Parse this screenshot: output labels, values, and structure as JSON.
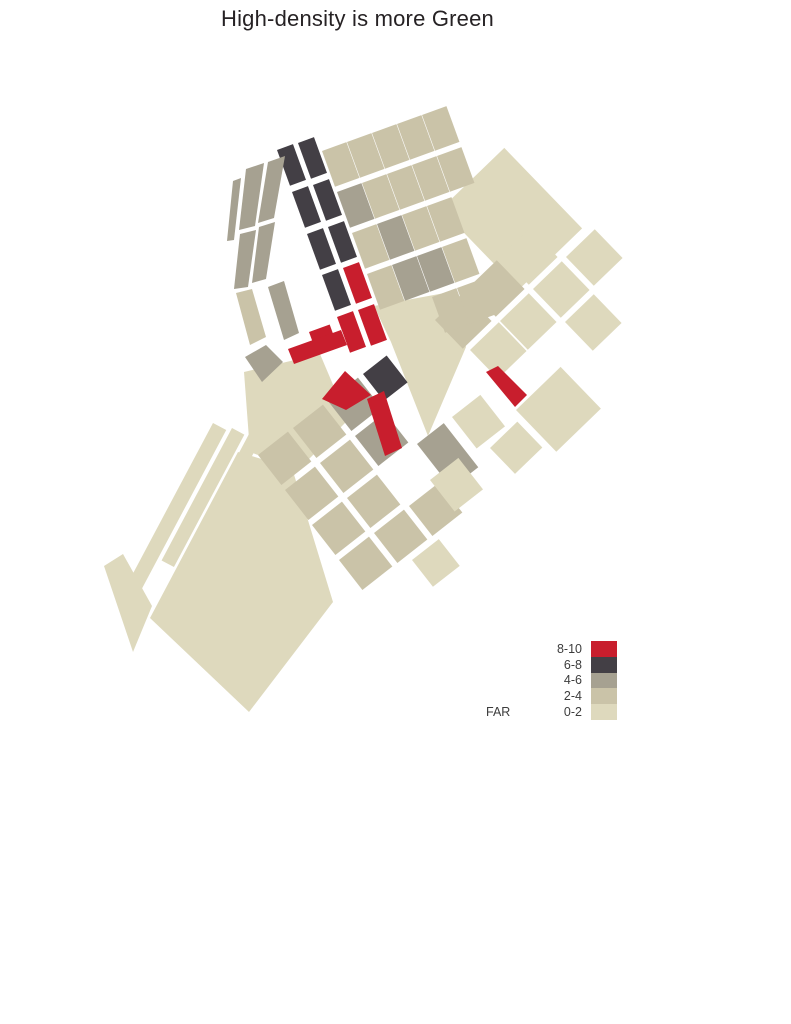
{
  "title": "High-density is more Green",
  "legend": {
    "label": "FAR",
    "entries": [
      {
        "range": "8-10",
        "color": "#c81e2d"
      },
      {
        "range": "6-8",
        "color": "#433f45"
      },
      {
        "range": "4-6",
        "color": "#a6a191"
      },
      {
        "range": "2-4",
        "color": "#cac3a8"
      },
      {
        "range": "0-2",
        "color": "#ded9bd"
      }
    ]
  },
  "map": {
    "blocks": [
      {
        "far": "0-2",
        "points": "374,306 450,292 466,347 428,436 391,342"
      },
      {
        "far": "0-2",
        "points": "244,372 320,354 348,420 298,470 250,452"
      },
      {
        "far": "0-2",
        "x": 213,
        "y": 423,
        "w": 15,
        "h": 195,
        "r": 28
      },
      {
        "far": "0-2",
        "x": 232,
        "y": 428,
        "w": 14,
        "h": 150,
        "r": 28
      },
      {
        "far": "0-2",
        "x": 249,
        "y": 434,
        "w": 13,
        "h": 115,
        "r": 28
      },
      {
        "far": "0-2",
        "points": "150,618 238,452 292,468 333,602 249,712"
      },
      {
        "far": "0-2",
        "points": "104,566 123,554 152,606 133,652"
      },
      {
        "far": "2-4",
        "x": 258,
        "y": 455,
        "w": 38,
        "h": 38,
        "r": -38
      },
      {
        "far": "2-4",
        "x": 293,
        "y": 428,
        "w": 38,
        "h": 38,
        "r": -38
      },
      {
        "far": "4-6",
        "x": 328,
        "y": 401,
        "w": 38,
        "h": 38,
        "r": -38
      },
      {
        "far": "6-8",
        "x": 363,
        "y": 374,
        "w": 30,
        "h": 34,
        "r": -38
      },
      {
        "far": "2-4",
        "x": 285,
        "y": 490,
        "w": 38,
        "h": 38,
        "r": -38
      },
      {
        "far": "2-4",
        "x": 320,
        "y": 463,
        "w": 38,
        "h": 38,
        "r": -38
      },
      {
        "far": "4-6",
        "x": 355,
        "y": 436,
        "w": 38,
        "h": 38,
        "r": -38
      },
      {
        "far": "2-4",
        "x": 312,
        "y": 525,
        "w": 38,
        "h": 38,
        "r": -38
      },
      {
        "far": "2-4",
        "x": 347,
        "y": 498,
        "w": 38,
        "h": 38,
        "r": -38
      },
      {
        "far": "4-6",
        "x": 417,
        "y": 444,
        "w": 34,
        "h": 56,
        "r": -38
      },
      {
        "far": "2-4",
        "x": 339,
        "y": 560,
        "w": 38,
        "h": 38,
        "r": -38
      },
      {
        "far": "2-4",
        "x": 374,
        "y": 533,
        "w": 38,
        "h": 38,
        "r": -38
      },
      {
        "far": "2-4",
        "x": 409,
        "y": 506,
        "w": 38,
        "h": 38,
        "r": -38
      },
      {
        "far": "0-2",
        "x": 452,
        "y": 417,
        "w": 36,
        "h": 40,
        "r": -38
      },
      {
        "far": "0-2",
        "x": 430,
        "y": 480,
        "w": 36,
        "h": 40,
        "r": -38
      },
      {
        "far": "0-2",
        "x": 412,
        "y": 560,
        "w": 34,
        "h": 34,
        "r": -38
      },
      {
        "far": "0-2",
        "x": 441,
        "y": 209,
        "w": 88,
        "h": 112,
        "r": -44
      },
      {
        "far": "2-4",
        "x": 435,
        "y": 320,
        "w": 40,
        "h": 40,
        "r": -44
      },
      {
        "far": "2-4",
        "x": 468,
        "y": 288,
        "w": 40,
        "h": 40,
        "r": -44
      },
      {
        "far": "0-2",
        "x": 501,
        "y": 256,
        "w": 40,
        "h": 40,
        "r": -44
      },
      {
        "far": "0-2",
        "x": 470,
        "y": 350,
        "w": 40,
        "h": 40,
        "r": -44
      },
      {
        "far": "0-2",
        "x": 500,
        "y": 321,
        "w": 40,
        "h": 40,
        "r": -44
      },
      {
        "far": "0-2",
        "x": 533,
        "y": 289,
        "w": 40,
        "h": 40,
        "r": -44
      },
      {
        "far": "0-2",
        "x": 566,
        "y": 257,
        "w": 40,
        "h": 40,
        "r": -44
      },
      {
        "far": "0-2",
        "x": 565,
        "y": 322,
        "w": 40,
        "h": 40,
        "r": -44
      },
      {
        "far": "0-2",
        "x": 516,
        "y": 410,
        "w": 62,
        "h": 58,
        "r": -44
      },
      {
        "far": "0-2",
        "x": 490,
        "y": 448,
        "w": 38,
        "h": 36,
        "r": -44
      },
      {
        "far": "2-4",
        "x": 322,
        "y": 151,
        "w": 26,
        "h": 38,
        "r": -20
      },
      {
        "far": "2-4",
        "x": 347,
        "y": 142,
        "w": 26,
        "h": 38,
        "r": -20
      },
      {
        "far": "2-4",
        "x": 372,
        "y": 133,
        "w": 26,
        "h": 38,
        "r": -20
      },
      {
        "far": "2-4",
        "x": 397,
        "y": 124,
        "w": 26,
        "h": 38,
        "r": -20
      },
      {
        "far": "2-4",
        "x": 422,
        "y": 115,
        "w": 26,
        "h": 38,
        "r": -20
      },
      {
        "far": "4-6",
        "x": 337,
        "y": 192,
        "w": 26,
        "h": 38,
        "r": -20
      },
      {
        "far": "2-4",
        "x": 362,
        "y": 183,
        "w": 26,
        "h": 38,
        "r": -20
      },
      {
        "far": "2-4",
        "x": 387,
        "y": 174,
        "w": 26,
        "h": 38,
        "r": -20
      },
      {
        "far": "2-4",
        "x": 412,
        "y": 165,
        "w": 26,
        "h": 38,
        "r": -20
      },
      {
        "far": "2-4",
        "x": 437,
        "y": 156,
        "w": 26,
        "h": 38,
        "r": -20
      },
      {
        "far": "2-4",
        "x": 352,
        "y": 233,
        "w": 26,
        "h": 38,
        "r": -20
      },
      {
        "far": "4-6",
        "x": 377,
        "y": 224,
        "w": 26,
        "h": 38,
        "r": -20
      },
      {
        "far": "2-4",
        "x": 402,
        "y": 215,
        "w": 26,
        "h": 38,
        "r": -20
      },
      {
        "far": "2-4",
        "x": 427,
        "y": 206,
        "w": 26,
        "h": 38,
        "r": -20
      },
      {
        "far": "2-4",
        "x": 367,
        "y": 274,
        "w": 26,
        "h": 38,
        "r": -20
      },
      {
        "far": "4-6",
        "x": 392,
        "y": 265,
        "w": 26,
        "h": 38,
        "r": -20
      },
      {
        "far": "4-6",
        "x": 417,
        "y": 256,
        "w": 26,
        "h": 38,
        "r": -20
      },
      {
        "far": "2-4",
        "x": 442,
        "y": 247,
        "w": 26,
        "h": 38,
        "r": -20
      },
      {
        "far": "2-4",
        "x": 432,
        "y": 297,
        "w": 26,
        "h": 38,
        "r": -20
      },
      {
        "far": "2-4",
        "x": 457,
        "y": 288,
        "w": 26,
        "h": 38,
        "r": -20
      },
      {
        "far": "6-8",
        "x": 277,
        "y": 150,
        "w": 17,
        "h": 38,
        "r": -20
      },
      {
        "far": "6-8",
        "x": 292,
        "y": 192,
        "w": 17,
        "h": 38,
        "r": -20
      },
      {
        "far": "6-8",
        "x": 307,
        "y": 234,
        "w": 17,
        "h": 38,
        "r": -20
      },
      {
        "far": "6-8",
        "x": 322,
        "y": 275,
        "w": 17,
        "h": 38,
        "r": -20
      },
      {
        "far": "6-8",
        "x": 298,
        "y": 143,
        "w": 17,
        "h": 38,
        "r": -20
      },
      {
        "far": "6-8",
        "x": 313,
        "y": 185,
        "w": 17,
        "h": 38,
        "r": -20
      },
      {
        "far": "6-8",
        "x": 328,
        "y": 227,
        "w": 17,
        "h": 38,
        "r": -20
      },
      {
        "far": "4-6",
        "points": "233,181 241,178 234,240 227,241"
      },
      {
        "far": "4-6",
        "points": "246,169 264,163 255,226 239,230"
      },
      {
        "far": "4-6",
        "points": "240,234 256,230 248,287 234,289"
      },
      {
        "far": "4-6",
        "points": "268,162 285,156 274,218 258,223"
      },
      {
        "far": "4-6",
        "points": "259,227 275,222 266,279 252,283"
      },
      {
        "far": "4-6",
        "points": "268,287 284,281 299,333 284,340"
      },
      {
        "far": "2-4",
        "points": "236,293 252,289 266,337 250,345"
      },
      {
        "far": "4-6",
        "points": "245,357 266,345 283,362 262,382"
      },
      {
        "far": "8-10",
        "x": 337,
        "y": 317,
        "w": 17,
        "h": 38,
        "r": -20
      },
      {
        "far": "8-10",
        "x": 343,
        "y": 268,
        "w": 17,
        "h": 38,
        "r": -20
      },
      {
        "far": "8-10",
        "x": 358,
        "y": 310,
        "w": 17,
        "h": 38,
        "r": -20
      },
      {
        "far": "8-10",
        "x": 309,
        "y": 332,
        "w": 22,
        "h": 20,
        "r": -20
      },
      {
        "far": "8-10",
        "points": "288,349 341,330 347,345 294,364"
      },
      {
        "far": "8-10",
        "points": "322,399 345,371 371,395 346,410"
      },
      {
        "far": "8-10",
        "points": "367,399 384,391 402,448 385,456"
      },
      {
        "far": "8-10",
        "points": "486,372 498,366 527,395 515,407"
      }
    ]
  }
}
